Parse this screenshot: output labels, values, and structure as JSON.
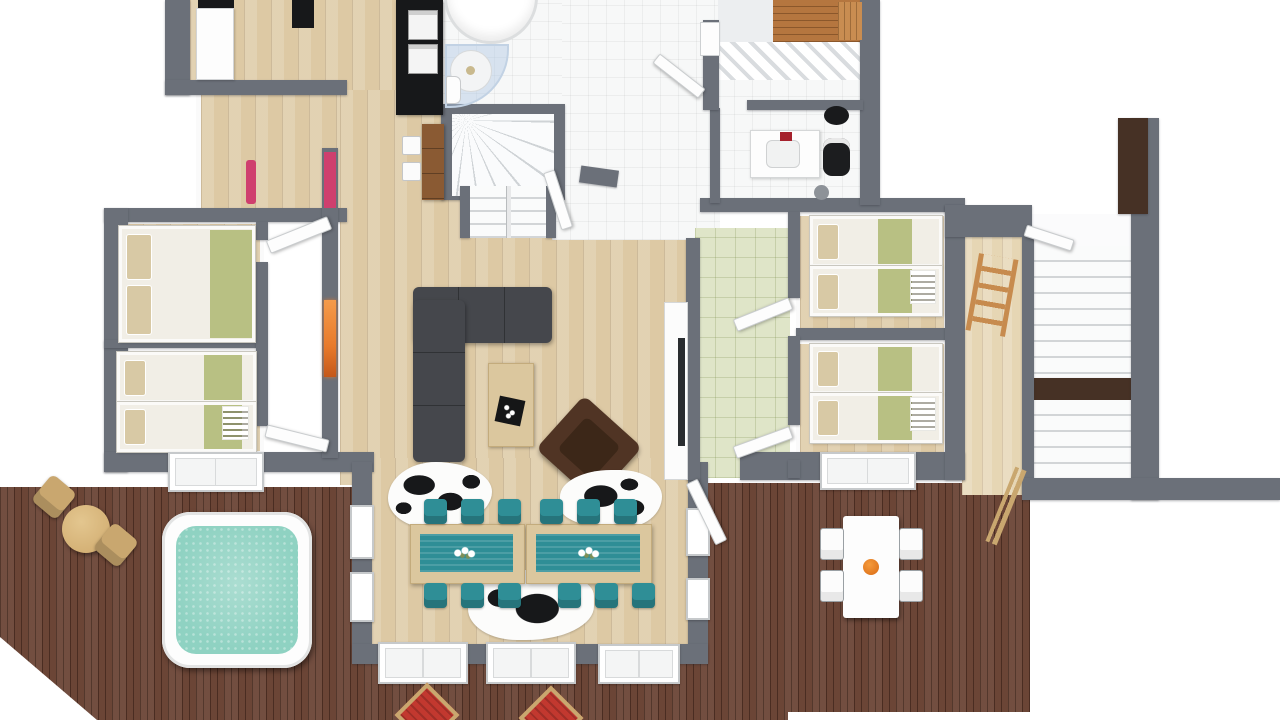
{
  "title": "3D floor plan — chalet apartment with wraparound deck",
  "palette": {
    "wall": "#6b7079",
    "wall_walnut": "#463125",
    "wood": "#ddc9a4",
    "deck": "#6b4536",
    "tile": "#f7f8f8",
    "green_tile": "#dfe5c8",
    "teal": "#2f8e96",
    "hot_tub_water": "#8fd2c2",
    "bed_green": "#b8c083",
    "pillow": "#d8c9a5",
    "mattress": "#f1eee6",
    "sofa": "#45474c",
    "armchair": "#503424",
    "table_wood": "#dbc79e",
    "lounger_red": "#c2382f",
    "frame_tan": "#c9a76f",
    "fireplace_orange": "#e87a2b",
    "sauna_wood": "#b5763f",
    "counter_black": "#17181a"
  },
  "rooms": [
    "pantry-kitchen",
    "bathroom-top",
    "winder-staircase",
    "entry-hall",
    "sauna",
    "bathroom-right",
    "bedroom-left-double",
    "bedroom-left-bunk",
    "hallway-left",
    "living-room",
    "dining-bay",
    "green-tile-hall",
    "bedroom-right-top-bunk",
    "bedroom-right-bottom-bunk",
    "mudroom",
    "external-staircase",
    "outdoor-deck"
  ],
  "furniture": [
    "double-bed",
    "bunk-bed-left",
    "bunk-bed-right-top",
    "bunk-bed-right-bottom",
    "l-shaped-sofa",
    "coffee-table",
    "brown-armchair",
    "cowhide-rug-1",
    "cowhide-rug-2",
    "cowhide-rug-3",
    "dining-table-left",
    "dining-table-right",
    "teal-chairs-x12",
    "corner-bathtub",
    "corner-shower",
    "vanity-sink",
    "black-toilet",
    "black-basin",
    "kitchen-counter",
    "bar-table",
    "hot-tub",
    "bistro-table",
    "bistro-chairs-x2",
    "outdoor-table-white",
    "outdoor-chairs-x4",
    "sun-loungers-red-x2",
    "wall-fireplace",
    "coat-rack",
    "skis",
    "window-benches"
  ],
  "counts": {
    "bedrooms": 4,
    "bathrooms": 2,
    "staircases": 2,
    "decks": 1,
    "hot_tubs": 1
  }
}
